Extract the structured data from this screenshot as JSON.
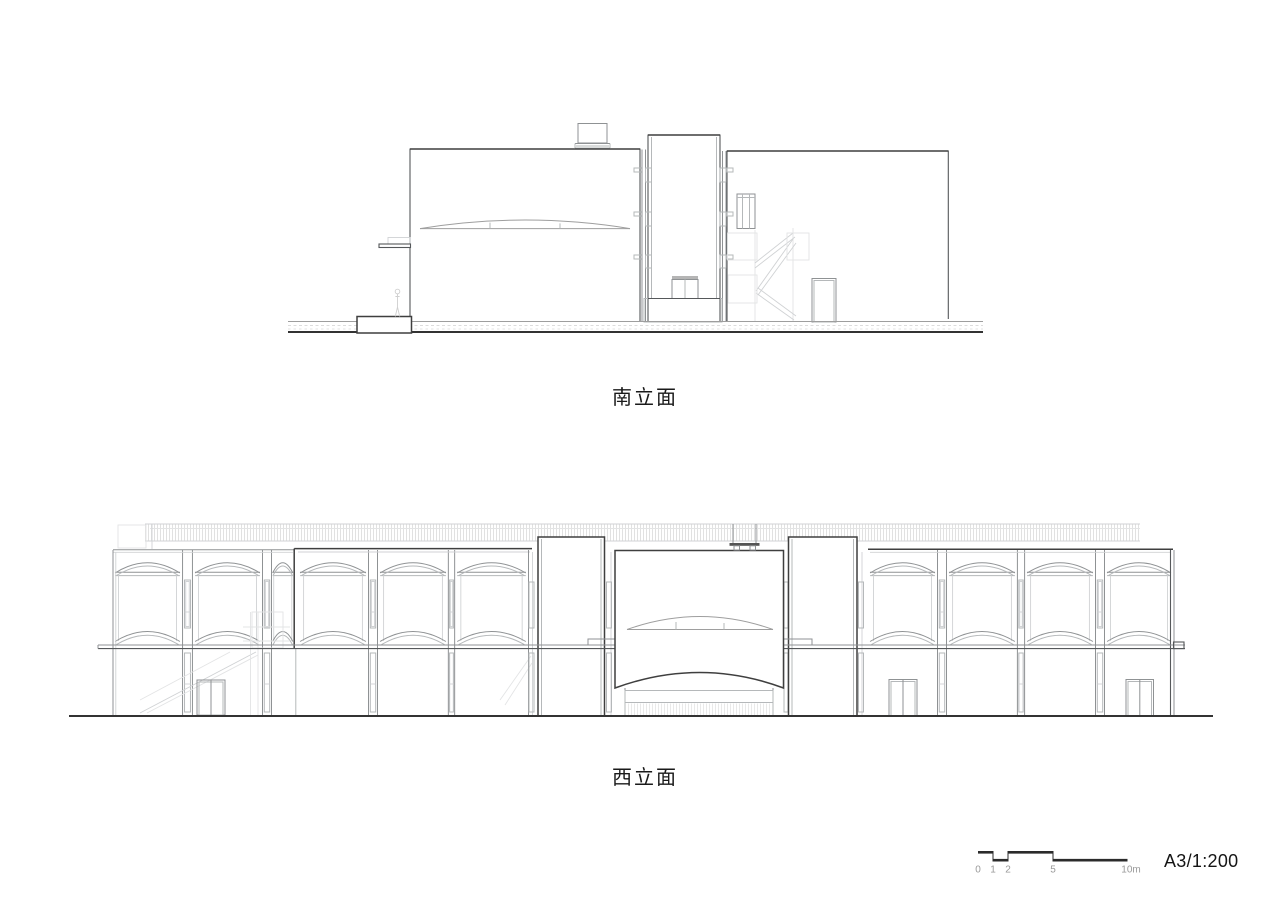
{
  "sheet": {
    "background": "#ffffff",
    "drawings": {
      "south_elevation": {
        "label": "南立面"
      },
      "west_elevation": {
        "label": "西立面"
      }
    },
    "title_block": {
      "format_scale": "A3/1:200",
      "scale_bar_ticks": [
        "0",
        "1",
        "2",
        "5",
        "10m"
      ]
    },
    "colors": {
      "outline_dark": "#3f3f3f",
      "line_medium": "#8f9294",
      "line_light": "#b5b8ba",
      "ground_line": "#333333",
      "text": "#1a1a1a",
      "tick_text": "#9a9a9a"
    }
  }
}
